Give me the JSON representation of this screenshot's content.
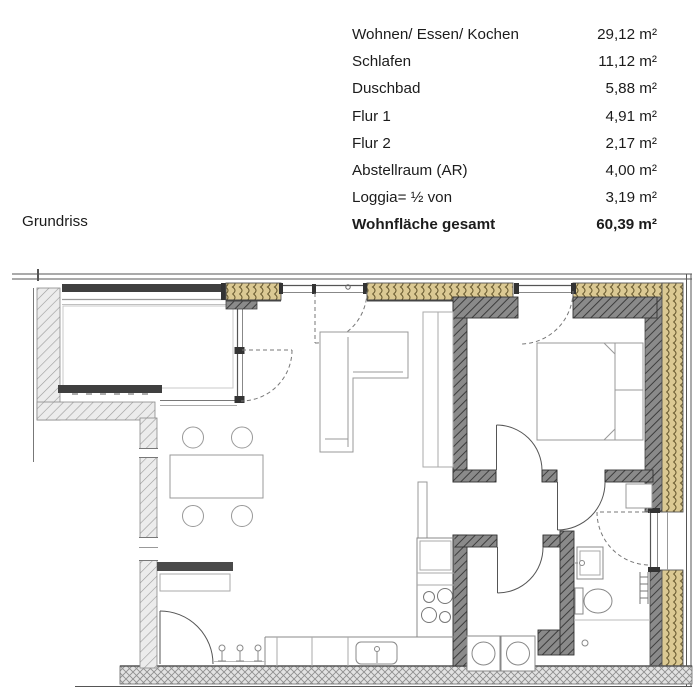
{
  "page": {
    "background": "#ffffff"
  },
  "plan_label": "Grundriss",
  "area_table": {
    "rows": [
      {
        "label": "Wohnen/ Essen/ Kochen",
        "value": "29,12 m²",
        "bold": false
      },
      {
        "label": "Schlafen",
        "value": "11,12 m²",
        "bold": false
      },
      {
        "label": "Duschbad",
        "value": "5,88 m²",
        "bold": false
      },
      {
        "label": "Flur 1",
        "value": "4,91 m²",
        "bold": false
      },
      {
        "label": "Flur 2",
        "value": "2,17 m²",
        "bold": false
      },
      {
        "label": "Abstellraum (AR)",
        "value": "4,00 m²",
        "bold": false
      },
      {
        "label": "Loggia= ½ von",
        "value": "3,19 m²",
        "bold": false
      },
      {
        "label": "Wohnfläche gesamt",
        "value": "60,39 m²",
        "bold": true
      }
    ]
  },
  "colors": {
    "text": "#1c1c1c",
    "wall_dark_band": "#3f3f3f",
    "interior_wall_hatch_bg": "#858585",
    "interior_wall_hatch_line": "#3d3d3d",
    "insulation_bg": "#dbc993",
    "insulation_line": "#6b5d33",
    "light_wall_hatch_bg": "#ececec",
    "light_wall_hatch_line": "#9b9b9b",
    "crosshatch_bg": "#e2e2e2",
    "crosshatch_line": "#8f8f8f",
    "furniture_line": "#999999",
    "door_line": "#555555"
  }
}
